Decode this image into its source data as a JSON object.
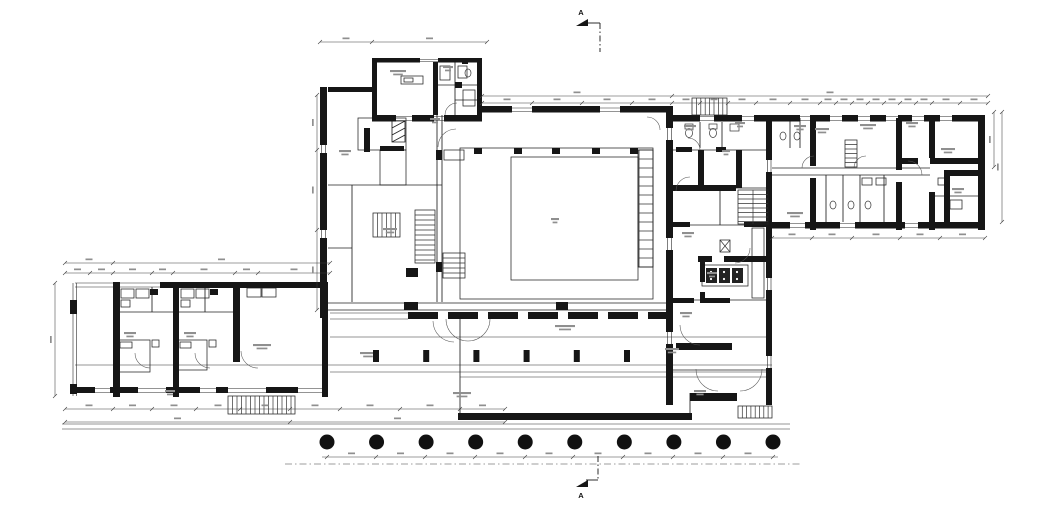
{
  "document": {
    "type": "architectural floor plan (ground floor)",
    "paper_color": "#ffffff",
    "ink_color": "#161616",
    "annotation_color": "#8f8f8f"
  },
  "section_markers": {
    "top_label": "A",
    "bottom_label": "A"
  },
  "plan": {
    "colonnade": {
      "count": 10,
      "x_start": 327,
      "x_end": 773,
      "y": 442,
      "radius": 7.5
    },
    "corridor_pilasters": {
      "count": 6,
      "x_start": 373,
      "spacing": 50.2,
      "y": 350,
      "width": 6,
      "height": 12
    }
  }
}
